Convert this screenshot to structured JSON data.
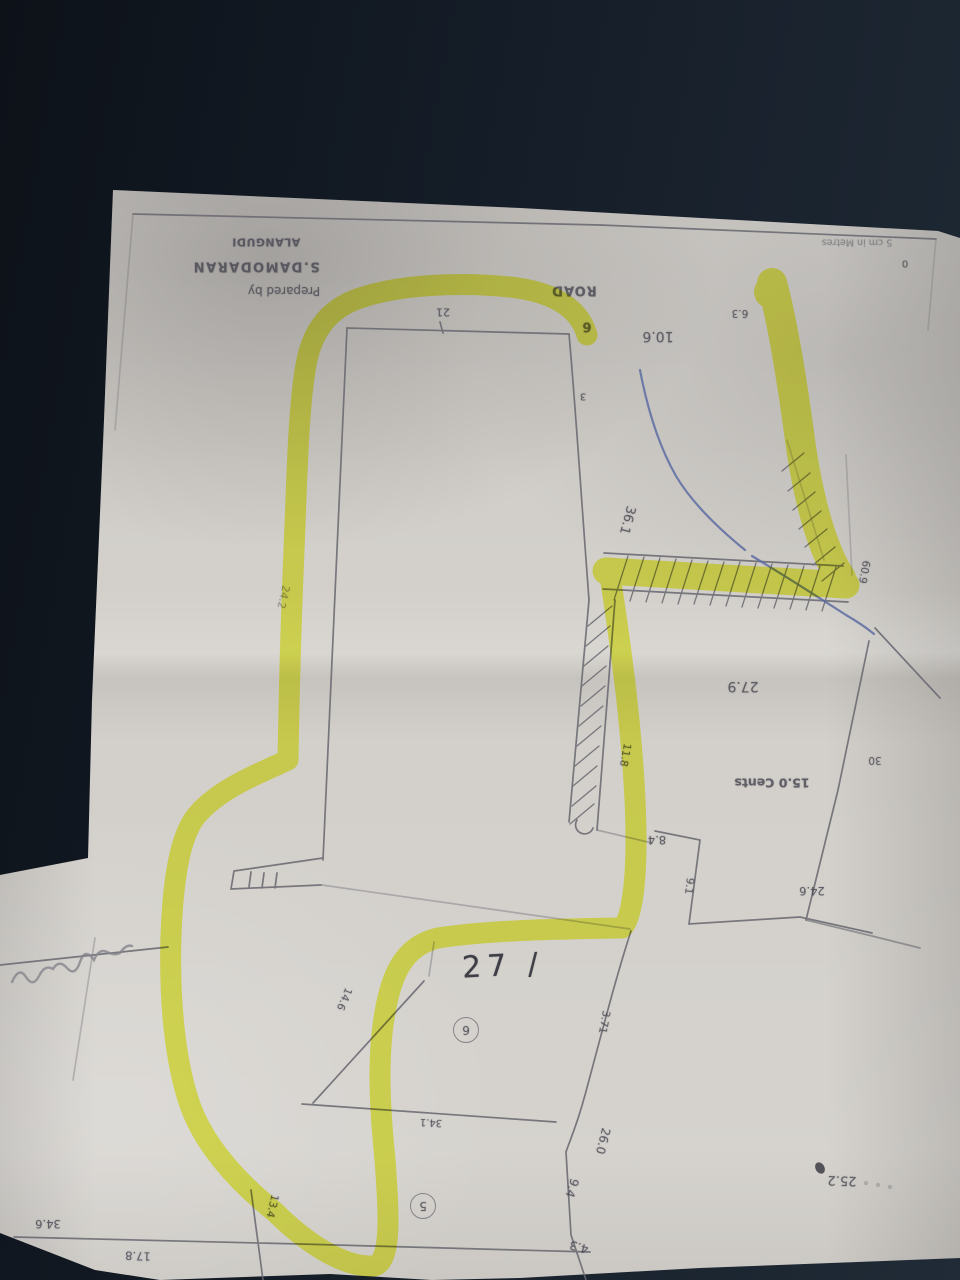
{
  "title_block": {
    "prepared_by": "Prepared by",
    "surveyor": "S.DAMODARAN",
    "village": "ALANGUDI"
  },
  "road_label": "ROAD",
  "scale_note": "5 cm in Metres",
  "area_label": "15.0 Cents",
  "plot_number": "27 /",
  "circled": {
    "c6": "6",
    "c5": "5"
  },
  "measurements": {
    "m0": "0",
    "m21": "21",
    "m6": "6",
    "m10_6": "10.6",
    "m6_3": "6.3",
    "m3": "3",
    "m36_1": "36.1",
    "m60_9": "60.9",
    "m24_2": "24.2",
    "m27_9": "27.9",
    "m30": "30",
    "m11_8": "11.8",
    "m8_4": "8.4",
    "m9_1": "9.1",
    "m24_6": "24.6",
    "m3_71": "3.71",
    "m14_6": "14.6",
    "m26_0": "26.0",
    "m9_4": "9.4",
    "m4_3": "4.3",
    "m34_1": "34.1",
    "m13_4": "13.4",
    "m17_8": "17.8",
    "m34_6": "34.6",
    "m25_2": "25.2"
  },
  "colors": {
    "background": "#161d28",
    "paper": "#d3d0cb",
    "highlighter": "#edf53d",
    "pencil": "#66666e",
    "blue_pen": "#5d6da2",
    "ink": "#2e2f38"
  }
}
